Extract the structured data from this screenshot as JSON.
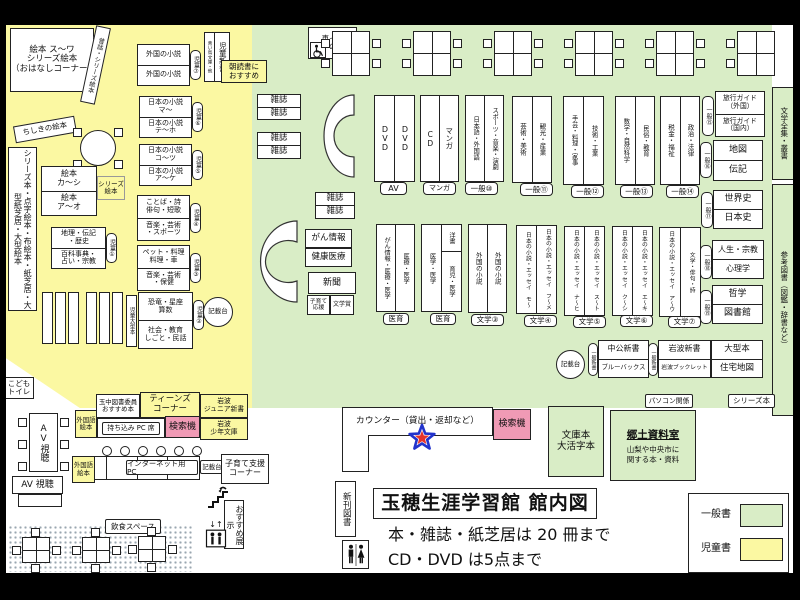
{
  "colors": {
    "general_green": "#d9edc6",
    "children_yellow": "#fbf8a2",
    "search_pink": "#f09ab5",
    "marker_red": "#e8332a",
    "marker_blue": "#2233cc"
  },
  "icons": {
    "wheelchair": "wheelchair-icon",
    "restroom": "restroom-icon",
    "stairs": "stairs-icon",
    "elevator": "elevator-icon",
    "marker": "location-star"
  },
  "header": {
    "title": "玉穂生涯学習館 館内図",
    "note1": "本・雑誌・紙芝居は 20 冊まで",
    "note2": "CD・DVD は5点まで"
  },
  "legend": {
    "general": "一般書",
    "children": "児童書"
  },
  "children_area": {
    "ohanashi": "絵本 ス～ワ\nシリーズ絵本\n（おはなしコーナー）",
    "mukashi_strip": "昔話・シリーズ絵本",
    "chishiki_strip": "ちしきの絵本",
    "left_strip": "シリーズ本・点字絵本・布絵本・紙芝居・大型紙芝居・大型絵本",
    "ehon": {
      "top": "絵本\nカ～シ",
      "bottom": "絵本\nア～オ"
    },
    "series_ehon": "シリーズ\n絵本",
    "shelves": [
      {
        "pill": "児童⑦",
        "top": "外国の小説",
        "bottom": "外国の小説"
      },
      {
        "pill": "児童⑥",
        "top": "日本の小説\nマ～",
        "bottom": "日本の小説\nテ～ホ"
      },
      {
        "pill": "児童⑤",
        "top": "日本の小説\nコ～ツ",
        "bottom": "日本の小説\nア～ケ"
      },
      {
        "pill": "児童④",
        "top": "ことば・詩\n俳句・短歌",
        "bottom": "音楽・芸術\n・スポーツ"
      },
      {
        "pill": "児童③",
        "top": "ペット・料理\n料理・車",
        "bottom": "音楽・芸術\n・保健"
      },
      {
        "pill": "児童②",
        "top": "恐竜・星座\n算数",
        "bottom": "社会・教育\nしごと・民話"
      },
      {
        "pill": "児童①",
        "top": "地理・伝記\n・歴史",
        "bottom": "百科事典・\n占い・宗教"
      }
    ],
    "jido_ogata": "児童大型本",
    "kisaidai": "記載台",
    "jidoshinsho": "児童新書",
    "aoitori": "青い鳥文庫・他",
    "asadoku": "朝読書に\nおすすめ",
    "kodomo_toilet": "こども\nトイレ"
  },
  "general_area": {
    "kurumaisu": "車イス用\nの机",
    "zasshi": "雑誌",
    "media": [
      {
        "tag": "AV",
        "left": "DVD",
        "right": "DVD"
      },
      {
        "tag": "マンガ",
        "left": "CD",
        "right": "マンガ"
      }
    ],
    "row1": [
      {
        "tag": "一般⑩",
        "left": "日本語・外国語",
        "right": "スポーツ・音楽・演劇"
      },
      {
        "tag": "一般⑪",
        "left": "芸術・美術",
        "right": "観光・産業"
      },
      {
        "tag": "一般⑫",
        "left": "手芸・料理・家事",
        "right": "技術・工業"
      },
      {
        "tag": "一般⑬",
        "left": "数学・自然科学",
        "right": "民俗・教育"
      },
      {
        "tag": "一般⑭",
        "left": "税金・福祉",
        "right": "政治・法律"
      }
    ],
    "row2": [
      {
        "tag": "医育",
        "left": "がん情報・医療・医学",
        "right": "医療・医学"
      },
      {
        "tag": "医育",
        "left": "医学・医学",
        "right_top": "洋書",
        "right_bottom": "育児・医学"
      },
      {
        "tag": "文学③",
        "left": "外国の小説",
        "right": "外国の小説"
      },
      {
        "tag": "文学④",
        "left": "日本の小説・エッセイ モ～",
        "right": "日本の小説・エッセイ フ～メ"
      },
      {
        "tag": "文学⑤",
        "left": "日本の小説・エッセイ ナ～ヒ",
        "right": "日本の小説・エッセイ ス～ト"
      },
      {
        "tag": "文学⑥",
        "left": "日本の小説・エッセイ ク～シ",
        "right": "日本の小説・エッセイ エ～キ"
      },
      {
        "tag": "文学⑦",
        "left": "日本の小説・エッセイ ア～ウ",
        "right": "文学・俳句・詩"
      }
    ],
    "info_boxes": {
      "gan": "がん情報",
      "kenko": "健康医療",
      "shinbun": "新聞",
      "kosodate_ouen": "子育て\n応援",
      "bungakusho": "文学賞"
    },
    "right_stack": [
      {
        "pill": "一般⑮",
        "top": "旅行ガイド\n（外国）",
        "bottom": "旅行ガイド\n（国内）"
      },
      {
        "pill": "一般⑯",
        "top": "地図",
        "bottom": "伝記"
      },
      {
        "pill": "一般⑰",
        "top": "世界史",
        "bottom": "日本史"
      },
      {
        "pill": "一般⑱",
        "top": "人生・宗教",
        "bottom": "心理学"
      },
      {
        "pill": "一般⑲",
        "top": "哲学",
        "bottom": "図書館"
      }
    ],
    "ogata": {
      "top": "大型本",
      "bottom": "住宅地図"
    },
    "strips": {
      "zenshu": "文学全集・叢書",
      "sanko": "参考図書（図鑑・辞書など）"
    },
    "shinsho": [
      {
        "pill": "一般新書",
        "top": "中公新書",
        "bottom": "ブルーバックス"
      },
      {
        "pill": "一般新書",
        "top": "岩波新書",
        "bottom": "岩波ブックレット"
      }
    ],
    "kisaidai": "記載台",
    "pasokon": "パソコン関係",
    "series_bon": "シリーズ本"
  },
  "service": {
    "counter": "カウンター（貸出・返却など）",
    "kensakuki": "検索機",
    "bunko": "文庫本\n大活字本",
    "kyodo": {
      "title": "郷土資料室",
      "sub": "山梨や中央市に\n関する本・資料"
    },
    "shinkan": "新刊図書",
    "teens": {
      "tama": "玉中図書委員\nおすすめ本",
      "corner": "ティーンズ\nコーナー",
      "iwanami_jr": "岩波\nジュニア新書",
      "gaikokugo": "外国語\n絵本",
      "pc": "持ち込み PC 席",
      "iwanami_shonen": "岩波\n少年文庫"
    },
    "av": {
      "table": "AV視聴",
      "booth": "AV 視聴"
    },
    "internet": {
      "pc": "インターネット用 PC",
      "kisaidai": "記載台",
      "kosodate": "子育て支援\nコーナー",
      "gaikokugo": "外国語\n絵本"
    },
    "osusume": "おすすめ展示",
    "inshoku": "飲食スペース"
  }
}
